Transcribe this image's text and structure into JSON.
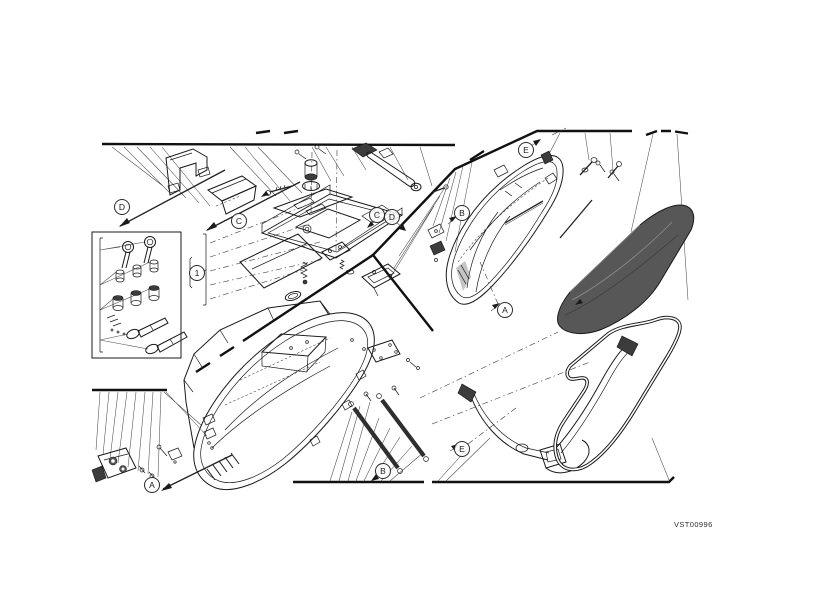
{
  "diagram": {
    "code": "VST00996",
    "background": "#ffffff",
    "line_color": "#1a1a1a",
    "lid_fill": "#575757",
    "callouts": [
      {
        "label": "D",
        "x": 122,
        "y": 207
      },
      {
        "label": "C",
        "x": 239,
        "y": 221
      },
      {
        "label": "C",
        "x": 377,
        "y": 215
      },
      {
        "label": "D",
        "x": 392,
        "y": 217
      },
      {
        "label": "E",
        "x": 526,
        "y": 150
      },
      {
        "label": "B",
        "x": 462,
        "y": 213
      },
      {
        "label": "A",
        "x": 505,
        "y": 310
      },
      {
        "label": "A",
        "x": 152,
        "y": 485
      },
      {
        "label": "B",
        "x": 383,
        "y": 471
      },
      {
        "label": "E",
        "x": 462,
        "y": 449
      },
      {
        "label": "1",
        "x": 197,
        "y": 273
      }
    ],
    "parts": [
      "handle-bracket",
      "cover-plate",
      "lock-set",
      "latch-base-assembly",
      "right-case-shell",
      "case-lid",
      "left-case-shell",
      "corner-latch",
      "mounting-straps",
      "carrying-strap",
      "seal-gasket"
    ]
  }
}
